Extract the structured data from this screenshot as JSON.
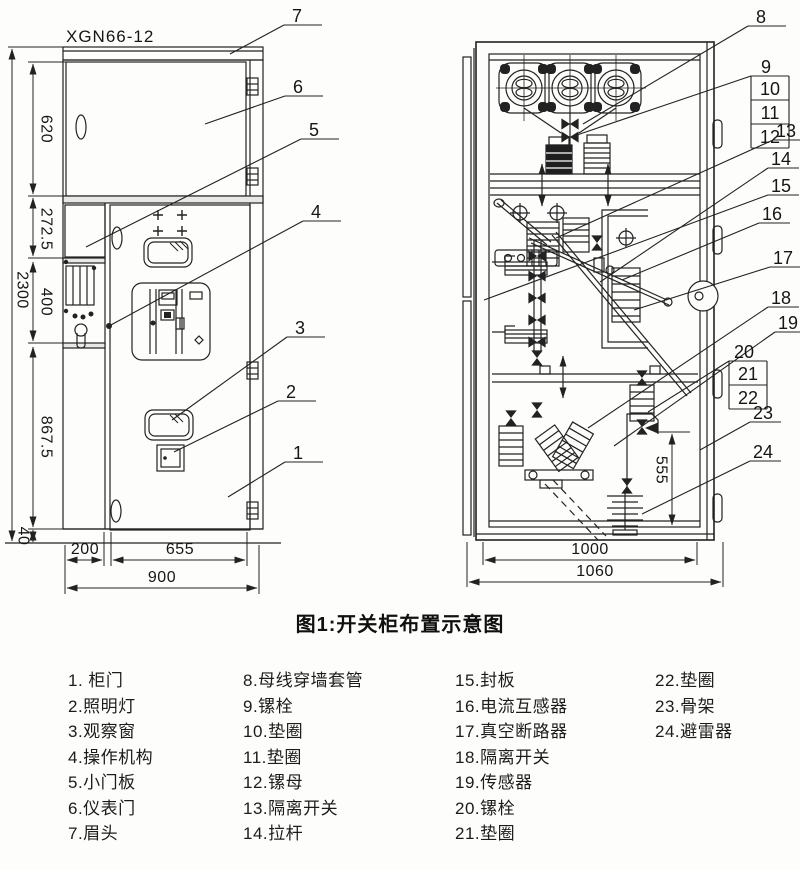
{
  "title": {
    "model": "XGN66-12"
  },
  "caption": "图1:开关柜布置示意图",
  "front_view": {
    "dimensions": {
      "overall_height": "2300",
      "seg_top": "620",
      "seg_upper": "272.5",
      "seg_mid": "400",
      "seg_lower": "867.5",
      "seg_base": "40",
      "col_width": "200",
      "door_width": "655",
      "total_width": "900"
    },
    "callouts": {
      "c1": "1",
      "c2": "2",
      "c3": "3",
      "c4": "4",
      "c5": "5",
      "c6": "6",
      "c7": "7"
    }
  },
  "side_view": {
    "dimensions": {
      "arrester_height": "555",
      "inner_width": "1000",
      "total_width": "1060"
    },
    "callouts": {
      "c8": "8",
      "c9": "9",
      "c10": "10",
      "c11": "11",
      "c12": "12",
      "c13": "13",
      "c14": "14",
      "c15": "15",
      "c16": "16",
      "c17": "17",
      "c18": "18",
      "c19": "19",
      "c20": "20",
      "c21": "21",
      "c22": "22",
      "c23": "23",
      "c24": "24"
    }
  },
  "legend": {
    "columns": [
      {
        "items": [
          "1. 柜门",
          "2.照明灯",
          "3.观察窗",
          "4.操作机构",
          "5.小门板",
          "6.仪表门",
          "7.眉头"
        ]
      },
      {
        "items": [
          "8.母线穿墙套管",
          "9.镙栓",
          "10.垫圈",
          "11.垫圈",
          "12.镙母",
          "13.隔离开关",
          "14.拉杆"
        ]
      },
      {
        "items": [
          "15.封板",
          "16.电流互感器",
          "17.真空断路器",
          "18.隔离开关",
          "19.传感器",
          "20.镙栓",
          "21.垫圈"
        ]
      },
      {
        "items": [
          "22.垫圈",
          "23.骨架",
          "24.避雷器"
        ]
      }
    ]
  },
  "colors": {
    "line": "#222222",
    "text": "#161616",
    "background": "#fdfdfb"
  }
}
